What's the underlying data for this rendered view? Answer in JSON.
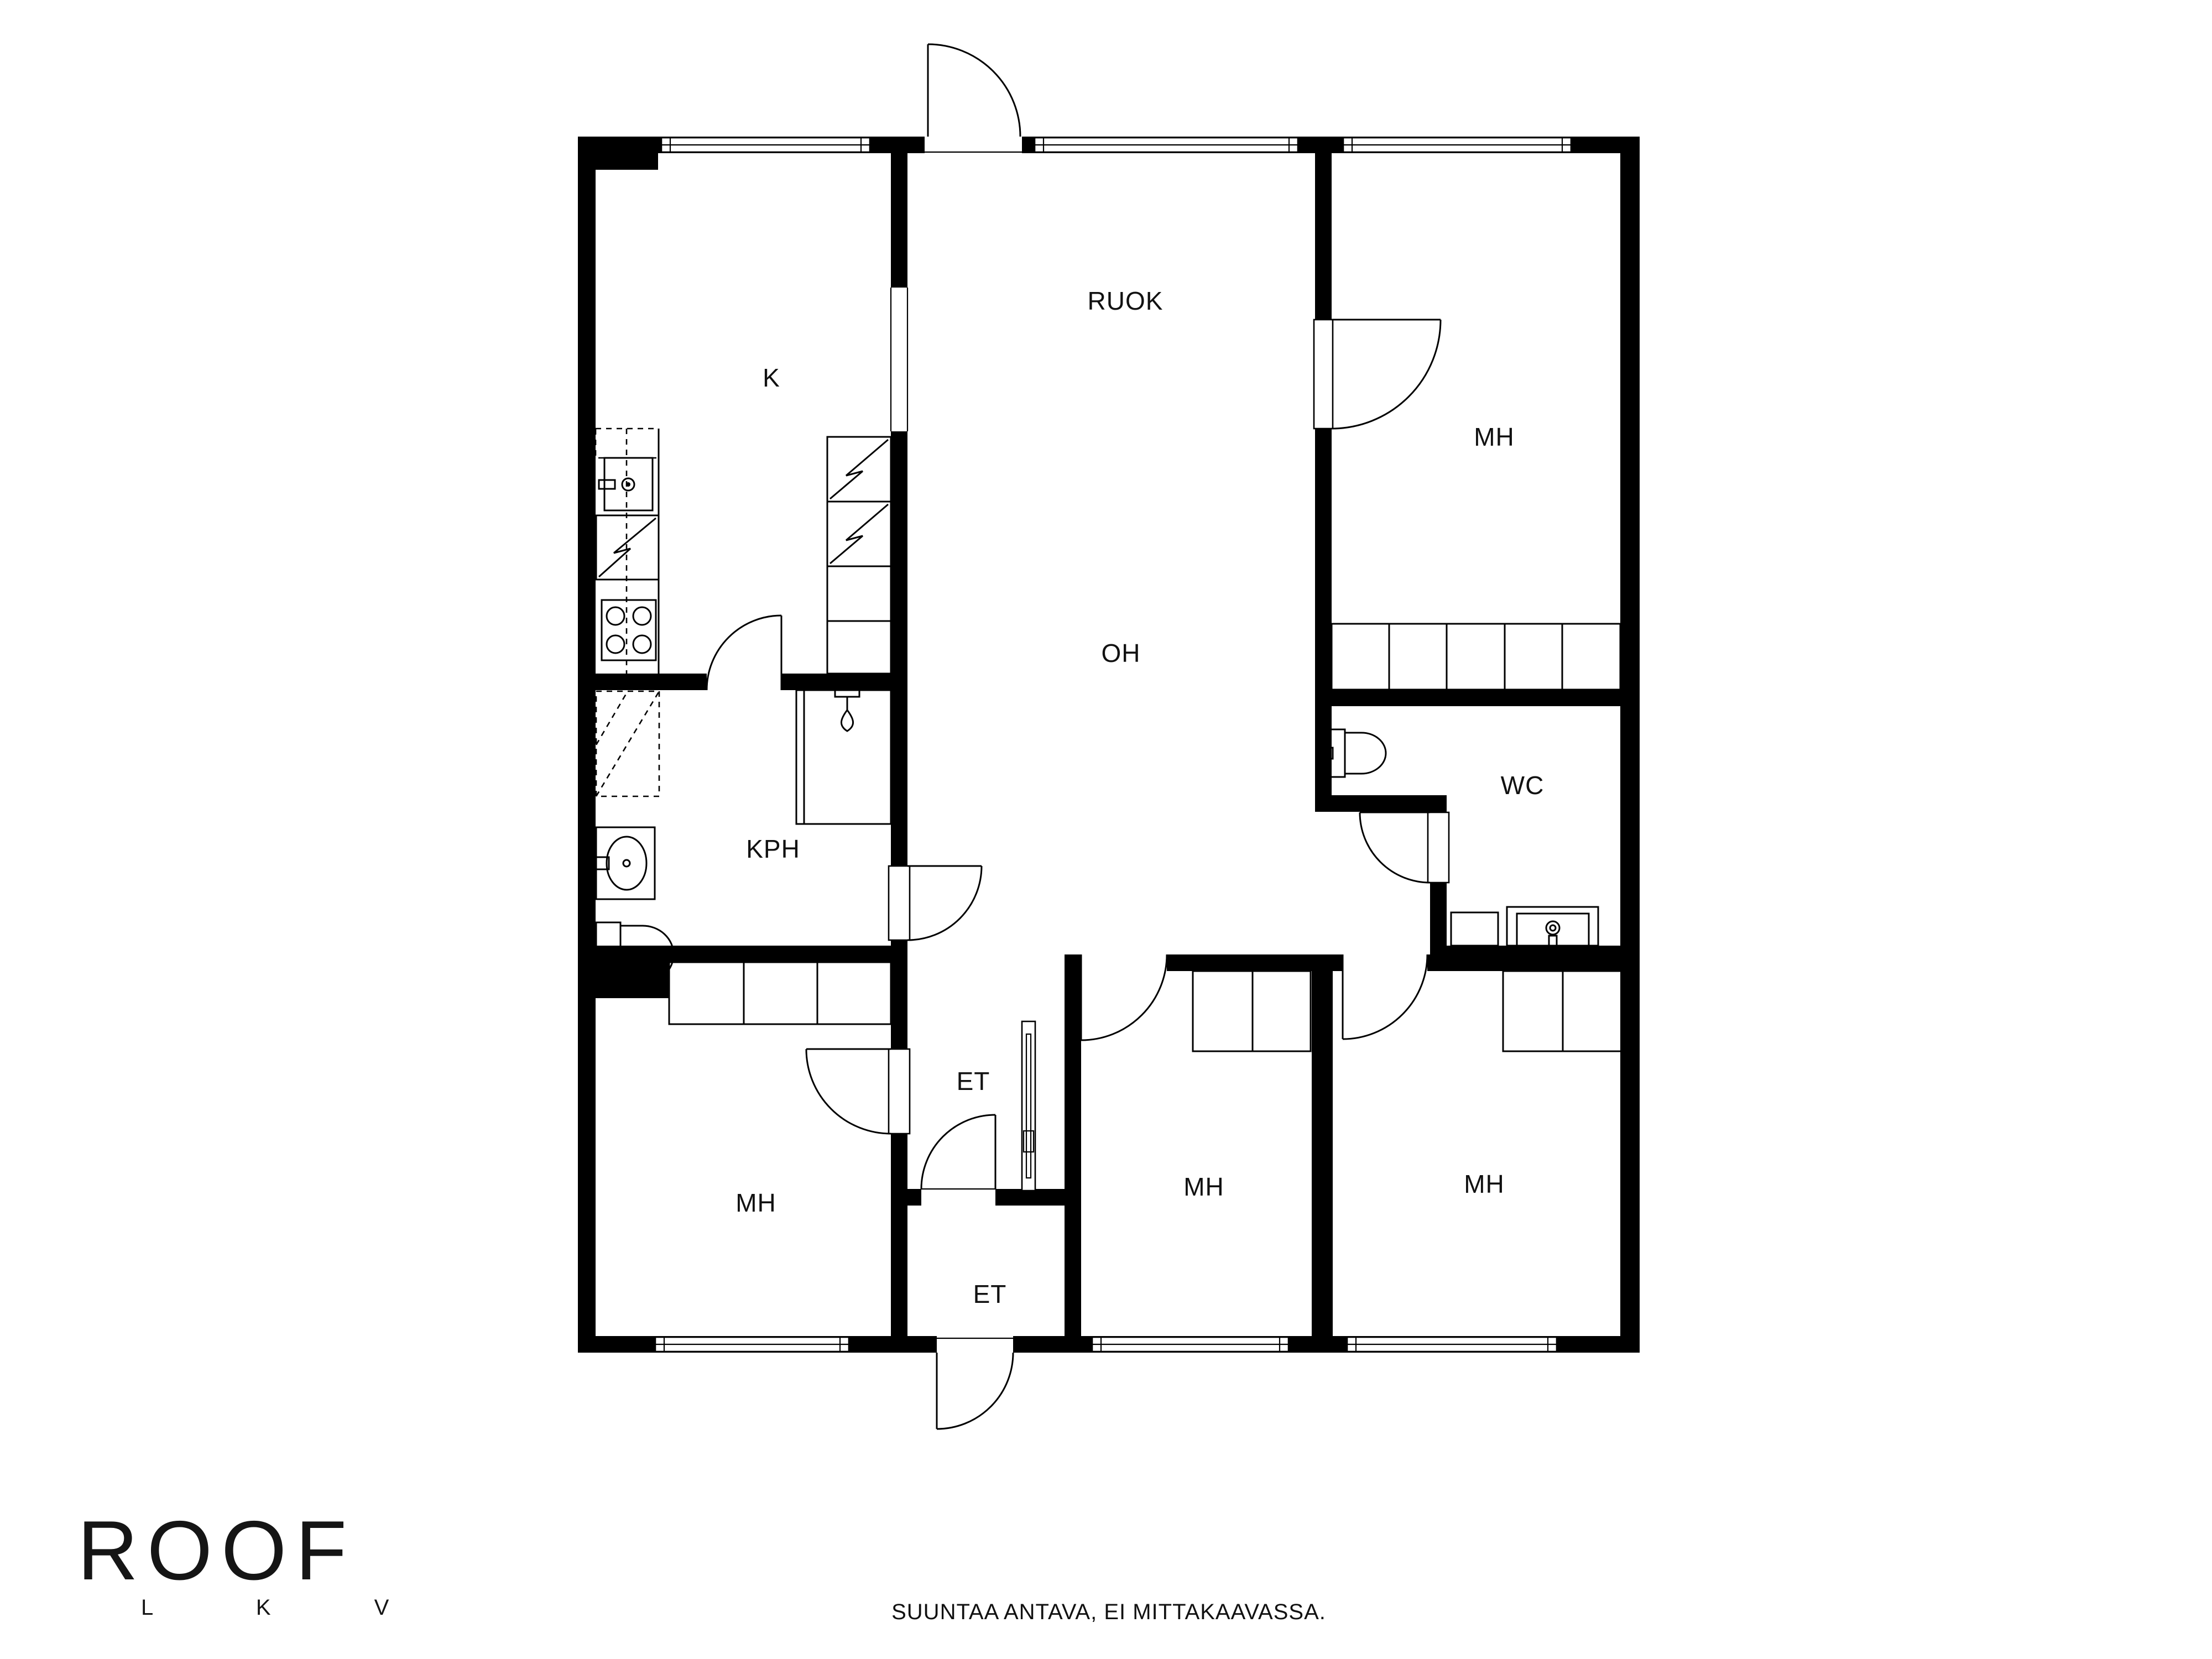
{
  "page": {
    "background": "#ffffff",
    "ink": "#000000"
  },
  "floorplan": {
    "rooms": [
      {
        "id": "kitchen",
        "label": "K"
      },
      {
        "id": "dining",
        "label": "RUOK"
      },
      {
        "id": "bedroom-top-right",
        "label": "MH"
      },
      {
        "id": "living-room",
        "label": "OH"
      },
      {
        "id": "toilet",
        "label": "WC"
      },
      {
        "id": "bathroom",
        "label": "KPH"
      },
      {
        "id": "hall-upper",
        "label": "ET"
      },
      {
        "id": "bedroom-bottom-left",
        "label": "MH"
      },
      {
        "id": "bedroom-bottom-middle",
        "label": "MH"
      },
      {
        "id": "bedroom-bottom-right",
        "label": "MH"
      },
      {
        "id": "hall-lower",
        "label": "ET"
      }
    ]
  },
  "logo": {
    "name": "ROOF",
    "subtitle": "L K V"
  },
  "footer": {
    "note": "SUUNTAA ANTAVA, EI MITTAKAAVASSA."
  }
}
